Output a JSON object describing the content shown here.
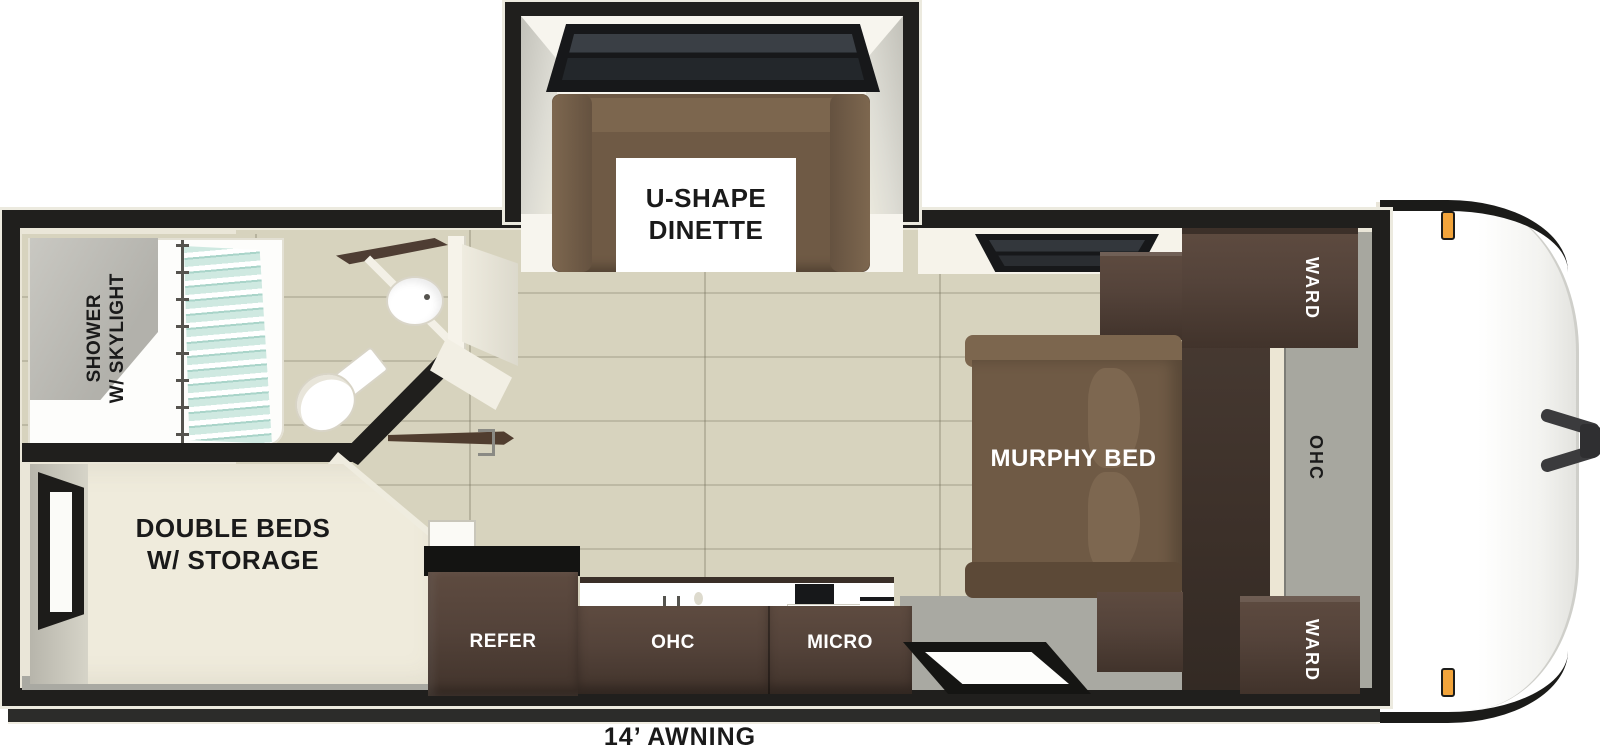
{
  "colors": {
    "wall": "#201f1d",
    "lining": "#eae6d8",
    "white": "#f7f5ee",
    "floor": "#d7d3be",
    "floor_seam": "#bdb9a4",
    "floor_gray": "#a9a9a2",
    "wall_gray": "#a7a79f",
    "cabinet": "#54433a",
    "cabinet_dark": "#3c3029",
    "sofa": "#6f5a45",
    "sofa_light": "#7c664e",
    "bed": "#efebdc",
    "curtain": "#cfe9e1",
    "amber": "#f2a43b",
    "awning": "#2c2c2a"
  },
  "floorplan": {
    "dinette": {
      "line1": "U-SHAPE",
      "line2": "DINETTE"
    },
    "bathroom": {
      "line1": "SHOWER",
      "line2": "W/ SKYLIGHT"
    },
    "bedroom": {
      "line1": "DOUBLE BEDS",
      "line2": "W/ STORAGE"
    },
    "murphy_bed_label": "MURPHY BED",
    "ward_top_label": "WARD",
    "ward_bottom_label": "WARD",
    "ohc_wall_label": "OHC",
    "kitchen": {
      "refer_label": "REFER",
      "ohc_label": "OHC",
      "micro_label": "MICRO"
    },
    "awning_label": "14’ AWNING"
  }
}
